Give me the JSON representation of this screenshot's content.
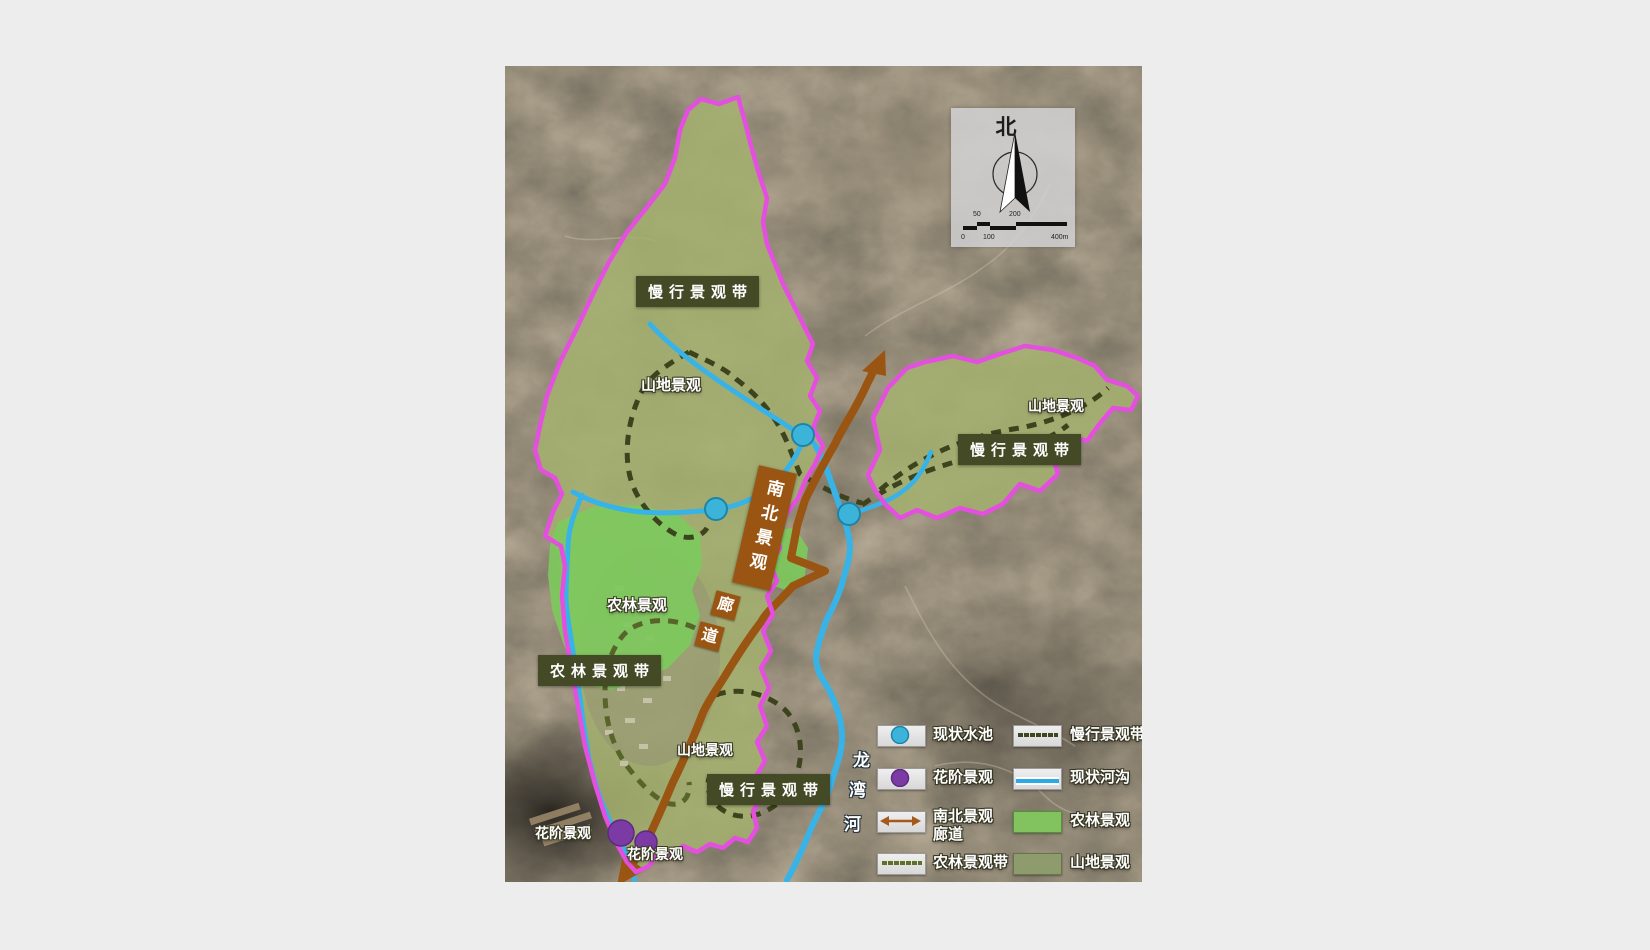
{
  "map": {
    "compass": {
      "north": "北"
    },
    "scale": {
      "above": [
        "50",
        "200"
      ],
      "below": [
        "0",
        "100",
        "400m"
      ]
    },
    "labels": {
      "belt_slow_top": "慢行景观带",
      "mountain_top": "山地景观",
      "mountain_right": "山地景观",
      "belt_slow_right": "慢行景观带",
      "corridor": "南北景观",
      "corridor_lang": "廊",
      "corridor_dao": "道",
      "farmland": "农林景观",
      "belt_farm": "农林景观带",
      "mountain_south": "山地景观",
      "belt_slow_south": "慢行景观带",
      "flower_left": "花阶景观",
      "flower_right": "花阶景观",
      "river": [
        "龙",
        "湾",
        "河"
      ]
    }
  },
  "legend": {
    "left": [
      {
        "label": "现状水池",
        "type": "water-pool"
      },
      {
        "label": "花阶景观",
        "type": "flower-terrace"
      },
      {
        "label": "南北景观",
        "label2": "廊道",
        "type": "corridor"
      },
      {
        "label": "农林景观带",
        "type": "farm-belt"
      }
    ],
    "right": [
      {
        "label": "慢行景观带",
        "type": "slow-belt"
      },
      {
        "label": "现状河沟",
        "type": "river"
      },
      {
        "label": "农林景观",
        "type": "farm"
      },
      {
        "label": "山地景观",
        "type": "mountain"
      }
    ]
  },
  "colors": {
    "boundary_magenta": "#e44fe0",
    "river_blue": "#38b3e8",
    "corridor_brown": "#9a5512",
    "farm_green": "#7ec95d",
    "mountain_green": "#a5b26e",
    "water_pool_cyan": "#3cb4d9",
    "flower_purple": "#7b3aa4",
    "label_box_olive": "#454a26"
  }
}
